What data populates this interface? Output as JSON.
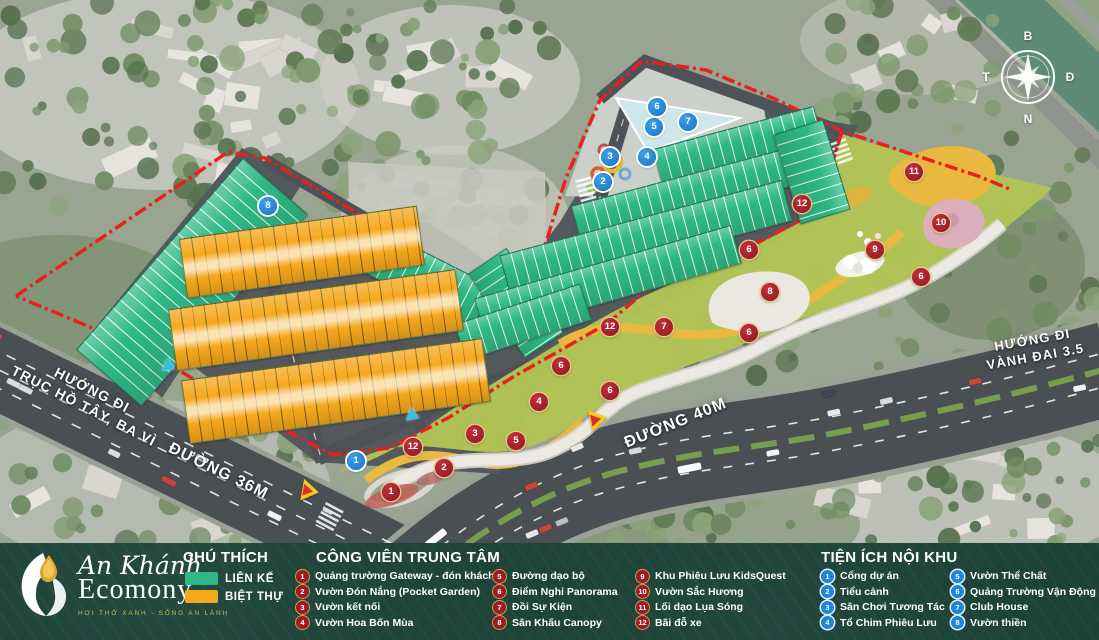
{
  "project": {
    "name1": "An Khánh",
    "name2": "Ecomony",
    "tagline": "HƠI THỞ XANH - SỐNG AN LÀNH"
  },
  "legend": {
    "title": "CHÚ THÍCH",
    "items": [
      {
        "label": "LIÊN KẾ",
        "color": "#2fb886"
      },
      {
        "label": "BIỆT THỰ",
        "color": "#f6a81c"
      }
    ]
  },
  "park_legend": {
    "title": "CÔNG VIÊN TRUNG TÂM",
    "marker_color": "#9c1c26",
    "items": [
      "Quảng trường Gateway - đón khách",
      "Vườn Đón Nắng (Pocket Garden)",
      "Vườn kết nối",
      "Vườn Hoa Bốn Mùa",
      "Đường dạo bộ",
      "Điểm Nghỉ Panorama",
      "Đồi Sự Kiện",
      "Sân Khấu Canopy",
      "Khu Phiêu Lưu KidsQuest",
      "Vườn Sắc Hương",
      "Lối dạo Lụa Sóng",
      "Bãi đỗ xe"
    ]
  },
  "amenity_legend": {
    "title": "TIỆN ÍCH NỘI KHU",
    "marker_color": "#1d86d8",
    "items": [
      "Cổng dự án",
      "Tiểu cảnh",
      "Sân Chơi Tương Tác",
      "Tổ Chim Phiêu Lưu",
      "Vườn Thể Chất",
      "Quảng Trường Vận Động",
      "Club House",
      "Vườn thiền"
    ]
  },
  "map": {
    "boundary_color": "#e8211d",
    "compass": {
      "n": "B",
      "e": "Đ",
      "s": "N",
      "w": "T"
    },
    "road_labels": [
      {
        "id": "huong-di-ho-tay",
        "lines": [
          "HƯỚNG ĐI",
          "TRỤC HỒ TÂY, BA VÌ"
        ],
        "x": 88,
        "y": 398,
        "rot": 27,
        "size": 14
      },
      {
        "id": "duong-36m",
        "lines": [
          "ĐƯỜNG 36M"
        ],
        "x": 218,
        "y": 472,
        "rot": 26,
        "size": 16
      },
      {
        "id": "duong-40m",
        "lines": [
          "ĐƯỜNG 40M"
        ],
        "x": 676,
        "y": 424,
        "rot": -22,
        "size": 16
      },
      {
        "id": "huong-di-vanh-dai",
        "lines": [
          "HƯỚNG ĐI",
          "VÀNH ĐAI 3.5"
        ],
        "x": 1034,
        "y": 349,
        "rot": -10,
        "size": 13
      }
    ],
    "red_markers": [
      {
        "n": "1",
        "x": 391,
        "y": 492
      },
      {
        "n": "2",
        "x": 444,
        "y": 468
      },
      {
        "n": "3",
        "x": 475,
        "y": 434
      },
      {
        "n": "4",
        "x": 539,
        "y": 402
      },
      {
        "n": "5",
        "x": 516,
        "y": 441
      },
      {
        "n": "6",
        "x": 561,
        "y": 366
      },
      {
        "n": "6",
        "x": 610,
        "y": 391
      },
      {
        "n": "6",
        "x": 749,
        "y": 250
      },
      {
        "n": "6",
        "x": 749,
        "y": 333
      },
      {
        "n": "6",
        "x": 921,
        "y": 277
      },
      {
        "n": "7",
        "x": 664,
        "y": 327
      },
      {
        "n": "8",
        "x": 770,
        "y": 292
      },
      {
        "n": "9",
        "x": 875,
        "y": 250
      },
      {
        "n": "10",
        "x": 941,
        "y": 223
      },
      {
        "n": "11",
        "x": 914,
        "y": 172
      },
      {
        "n": "12",
        "x": 413,
        "y": 447
      },
      {
        "n": "12",
        "x": 610,
        "y": 327
      },
      {
        "n": "12",
        "x": 802,
        "y": 204
      }
    ],
    "blue_markers": [
      {
        "n": "1",
        "x": 356,
        "y": 461
      },
      {
        "n": "2",
        "x": 603,
        "y": 182
      },
      {
        "n": "3",
        "x": 610,
        "y": 157
      },
      {
        "n": "4",
        "x": 647,
        "y": 157
      },
      {
        "n": "5",
        "x": 654,
        "y": 127
      },
      {
        "n": "6",
        "x": 657,
        "y": 107
      },
      {
        "n": "7",
        "x": 688,
        "y": 122
      },
      {
        "n": "8",
        "x": 268,
        "y": 206
      }
    ]
  }
}
